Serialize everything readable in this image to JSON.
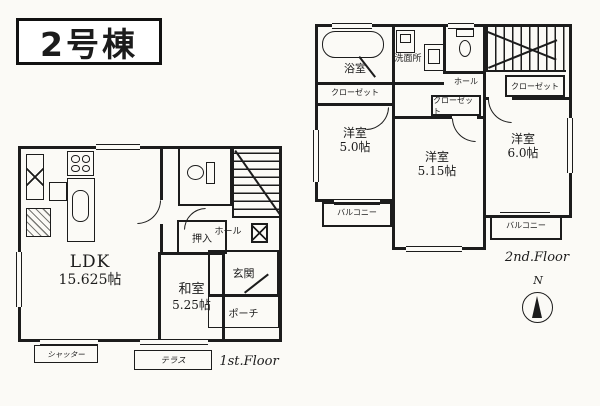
{
  "title": "2号棟",
  "floor1": {
    "floor_label": "1st.Floor",
    "ldk_name": "LDK",
    "ldk_size": "15.625帖",
    "washitsu_name": "和室",
    "washitsu_size": "5.25帖",
    "oshiire": "押入",
    "hall": "ホール",
    "genkan": "玄関",
    "porch": "ポーチ",
    "shutter": "シャッター",
    "terrace": "テラス"
  },
  "floor2": {
    "floor_label": "2nd.Floor",
    "bath": "浴室",
    "washroom": "洗面所",
    "closet_bath": "クローゼット",
    "closet_mid": "クローゼット",
    "closet_stairs": "クローゼット",
    "hall": "ホール",
    "room1_name": "洋室",
    "room1_size": "5.0帖",
    "room2_name": "洋室",
    "room2_size": "5.15帖",
    "room3_name": "洋室",
    "room3_size": "6.0帖",
    "balcony_left": "バルコニー",
    "balcony_right": "バルコニー"
  },
  "compass": {
    "north": "N"
  },
  "colors": {
    "line": "#1c1c1c",
    "paper": "#fbfaf6"
  }
}
